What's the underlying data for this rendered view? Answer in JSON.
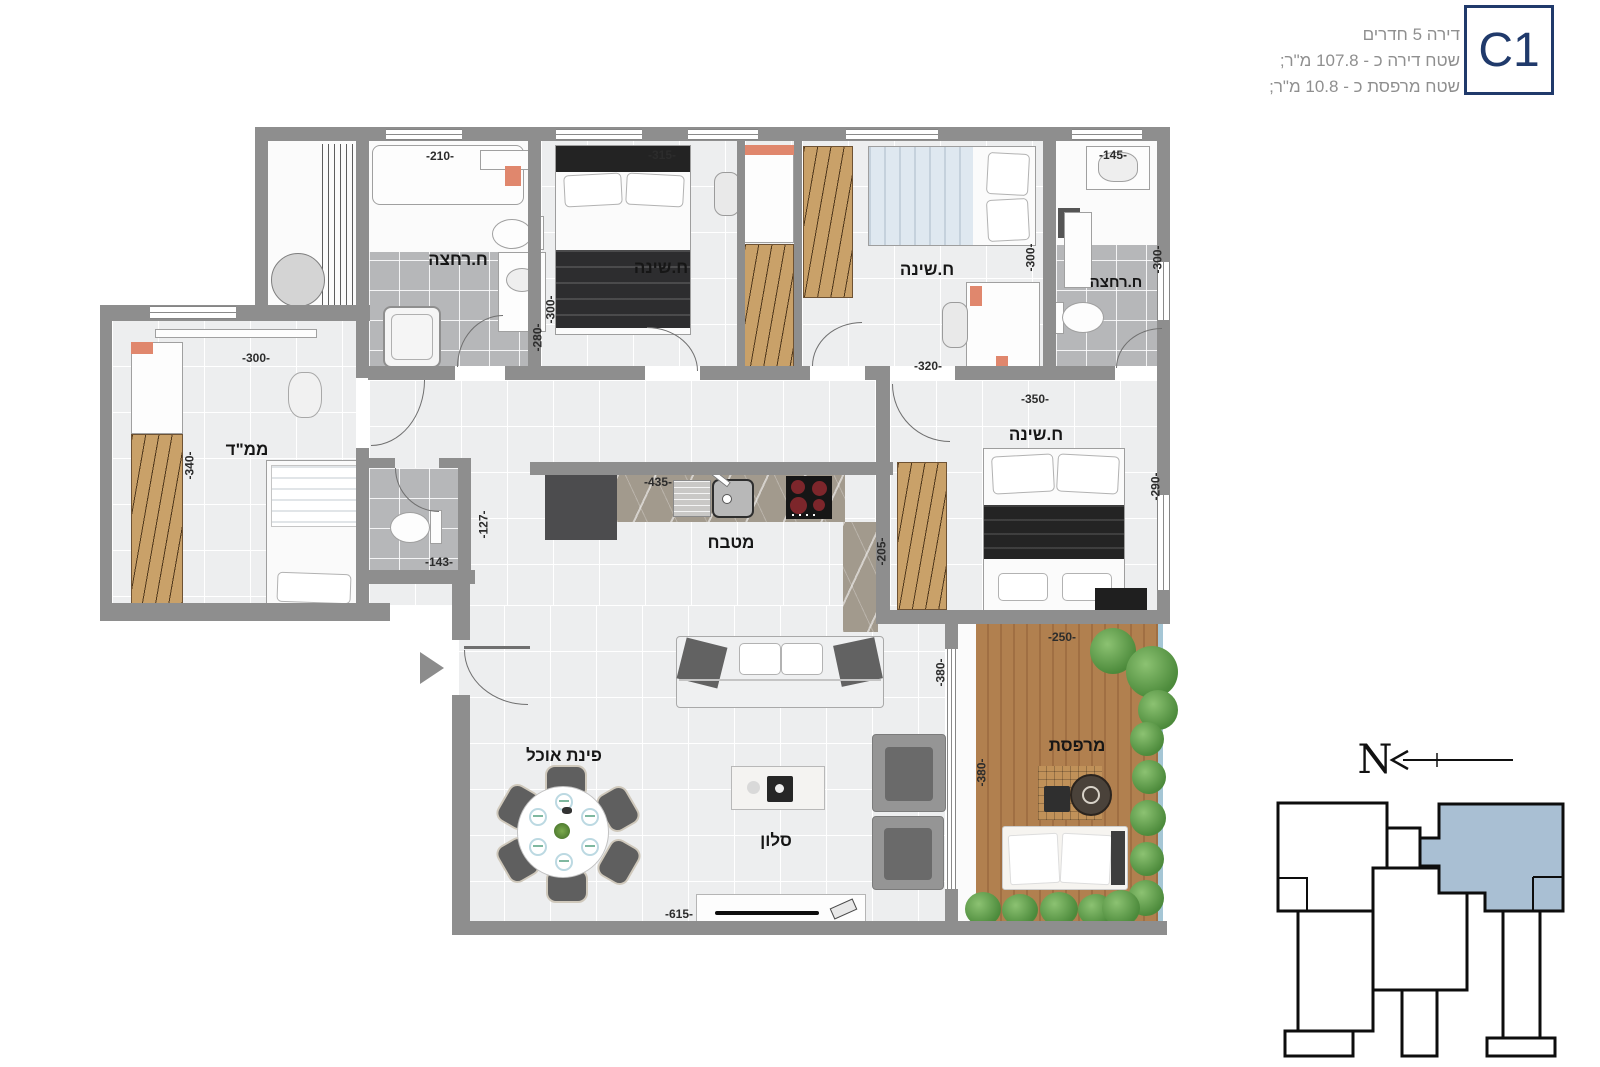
{
  "header": {
    "title": "דירה 5 חדרים",
    "apartment_area": "שטח דירה כ - 107.8 מ\"ר;",
    "balcony_area": "שטח מרפסת כ - 10.8 מ\"ר;",
    "unit_badge": "C1"
  },
  "plan": {
    "rooms": {
      "bath1": {
        "label": "ח.רחצה",
        "dim_width": "-210-",
        "dim_height": "-280-"
      },
      "bed1": {
        "label": "ח.שינה",
        "dim_width": "-315-",
        "dim_height": "-300-"
      },
      "bed2": {
        "label": "ח.שינה",
        "dim_width": "-320-",
        "dim_height": "-300-"
      },
      "bath2": {
        "label": "ח.רחצה",
        "dim_width": "-145-",
        "dim_height": "-300-"
      },
      "mamad": {
        "label": "ממ\"ד",
        "dim_width": "-300-",
        "dim_height": "-340-"
      },
      "wc": {
        "dim_width": "-143-",
        "dim_height": "-127-"
      },
      "kitchen": {
        "label": "מטבח",
        "dim_width": "-435-",
        "dim_height": "-205-"
      },
      "master_bedroom": {
        "label": "ח.שינה",
        "dim_width": "-350-",
        "dim_height": "-290-"
      },
      "dining": {
        "label": "פינת אוכל"
      },
      "living": {
        "label": "סלון",
        "dim_width": "-615-",
        "dim_height": "-380-"
      },
      "balcony": {
        "label": "מרפסת",
        "dim_width": "-250-",
        "dim_height": "-380-"
      }
    }
  },
  "keyplan": {
    "north_label": "N"
  },
  "colors": {
    "accent_navy": "#203a6b",
    "highlight_unit_blue": "#a9bfd3",
    "wall_gray": "#8e8e8e"
  }
}
